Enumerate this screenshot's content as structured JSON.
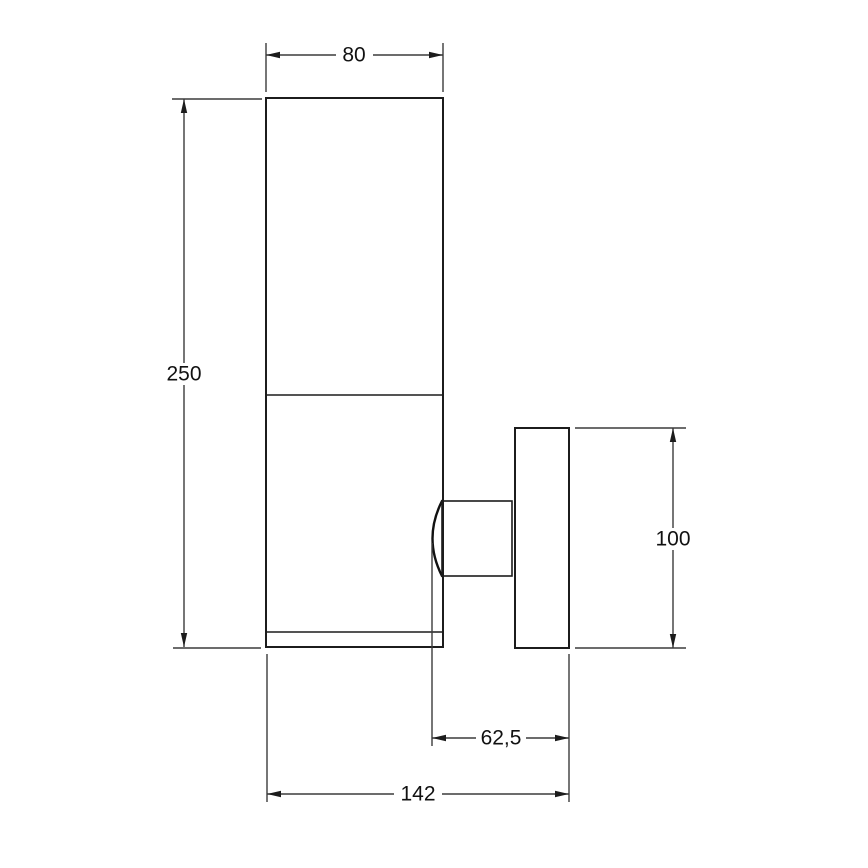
{
  "drawing": {
    "type": "technical-line-drawing",
    "subject": "wall-mounted light fixture, side elevation with dimensions",
    "colors": {
      "background": "#ffffff",
      "object_line": "#1c1c1c",
      "dimension_line": "#3c3c3c",
      "text": "#111111"
    },
    "dimensions": {
      "body_width": {
        "label": "80"
      },
      "body_height": {
        "label": "250"
      },
      "plate_height": {
        "label": "100"
      },
      "arm_depth": {
        "label": "62,5"
      },
      "total_depth": {
        "label": "142"
      }
    }
  }
}
